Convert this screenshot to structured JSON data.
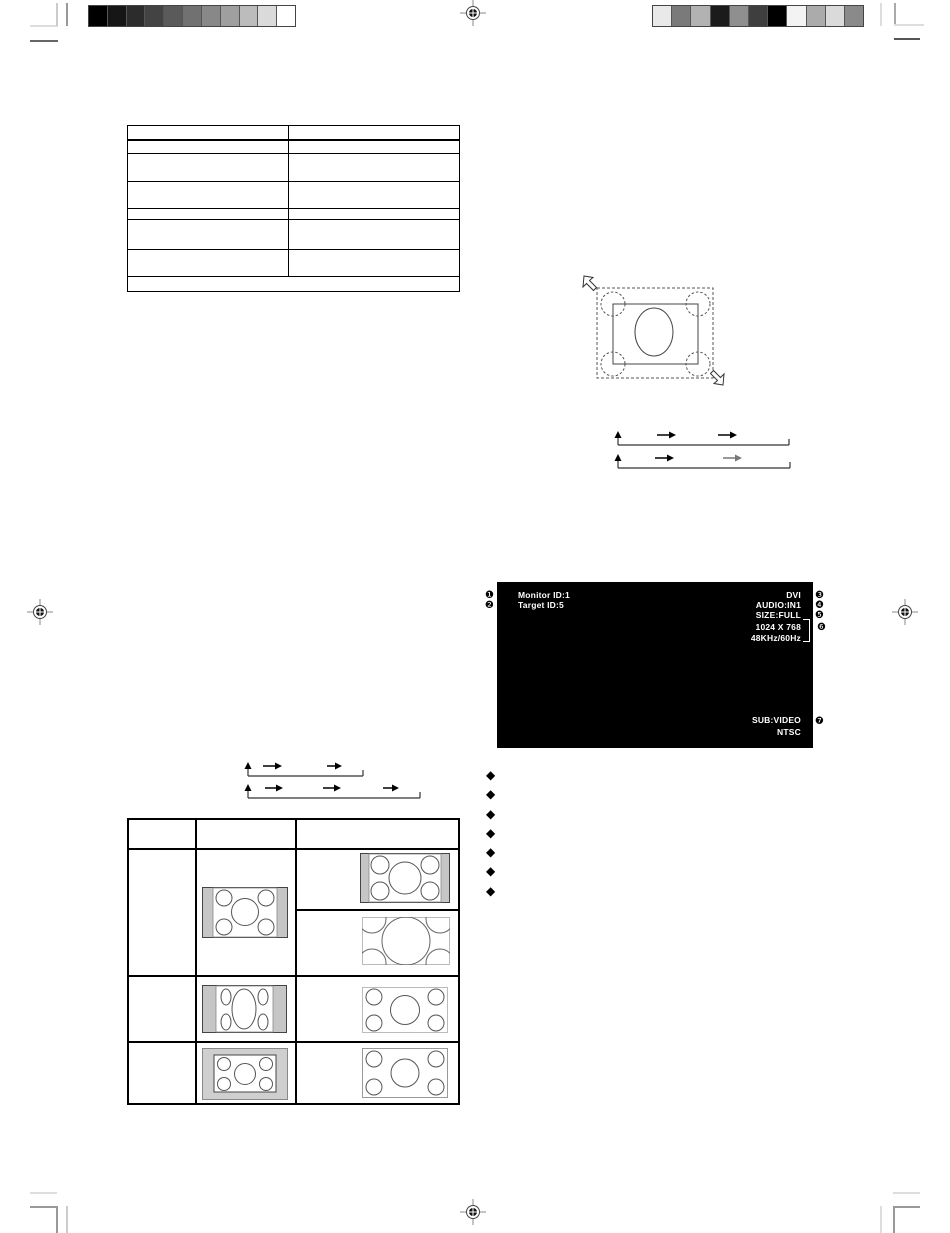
{
  "page": {
    "background": "#ffffff"
  },
  "print_marks": {
    "left_grayscale_bar": [
      "#000000",
      "#161616",
      "#2c2c2c",
      "#434343",
      "#5a5a5a",
      "#717171",
      "#888888",
      "#9f9f9f",
      "#bcbcbc",
      "#dadada",
      "#ffffff"
    ],
    "right_grayscale_bar": [
      "#e9e9e9",
      "#7a7a7a",
      "#b2b2b2",
      "#1b1b1b",
      "#8f8f8f",
      "#3e3e3e",
      "#000000",
      "#f3f3f3",
      "#ababab",
      "#dadada",
      "#8a8a8a"
    ]
  },
  "spec_table": {
    "columns": 2,
    "rows": 8,
    "cell_text": ""
  },
  "osd": {
    "bg": "#000000",
    "fg": "#ffffff",
    "monitor_id": "Monitor ID:1",
    "target_id": "Target ID:5",
    "input": "DVI",
    "audio": "AUDIO:IN1",
    "size": "SIZE:FULL",
    "resolution": "1024 X 768",
    "frequency": "48KHz/60Hz",
    "sub_input": "SUB:VIDEO",
    "sub_format": "NTSC"
  },
  "callouts": {
    "c1": "❶",
    "c2": "❷",
    "c3": "❸",
    "c4": "❹",
    "c5": "❺",
    "c6": "❻",
    "c7": "❼"
  },
  "bullets": {
    "glyph": "◆",
    "count": 7
  },
  "size_table": {
    "columns": 3,
    "rows": 3,
    "header_text": "",
    "cell_text": "",
    "bar_color": "#c6c6c6"
  }
}
